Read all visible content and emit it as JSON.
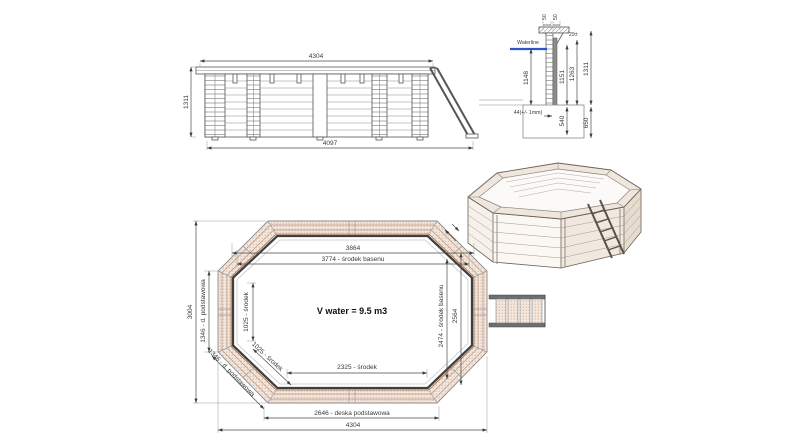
{
  "drawing": {
    "elevation": {
      "top": "4304",
      "left": "1311",
      "bottom": "4097"
    },
    "section": {
      "waterline_label": "Waterline",
      "top_left": "50",
      "top_right": "50",
      "thickness": "29±",
      "h1148": "1148",
      "h1151": "1151",
      "h1263": "1263",
      "h1311": "1311",
      "h540": "540",
      "h650": "650",
      "base_note": "44(+/- 1mm)"
    },
    "plan": {
      "w3864": "3864",
      "w3774": "3774 - środek basenu",
      "h3004": "3004",
      "d1346": "1346 - d. podstawowa",
      "d1025": "1025 - środek",
      "h2474": "2474 - środek basenu",
      "h2564": "2564",
      "w2325": "2325 - środek",
      "w2646": "2646 - deska podstawowa",
      "w4304": "4304",
      "volume": "V water = 9.5 m3"
    },
    "colors": {
      "waterline": "#2f55c4",
      "wood_dot": "#cda28b",
      "wall_dark": "#3f3f3f"
    }
  }
}
